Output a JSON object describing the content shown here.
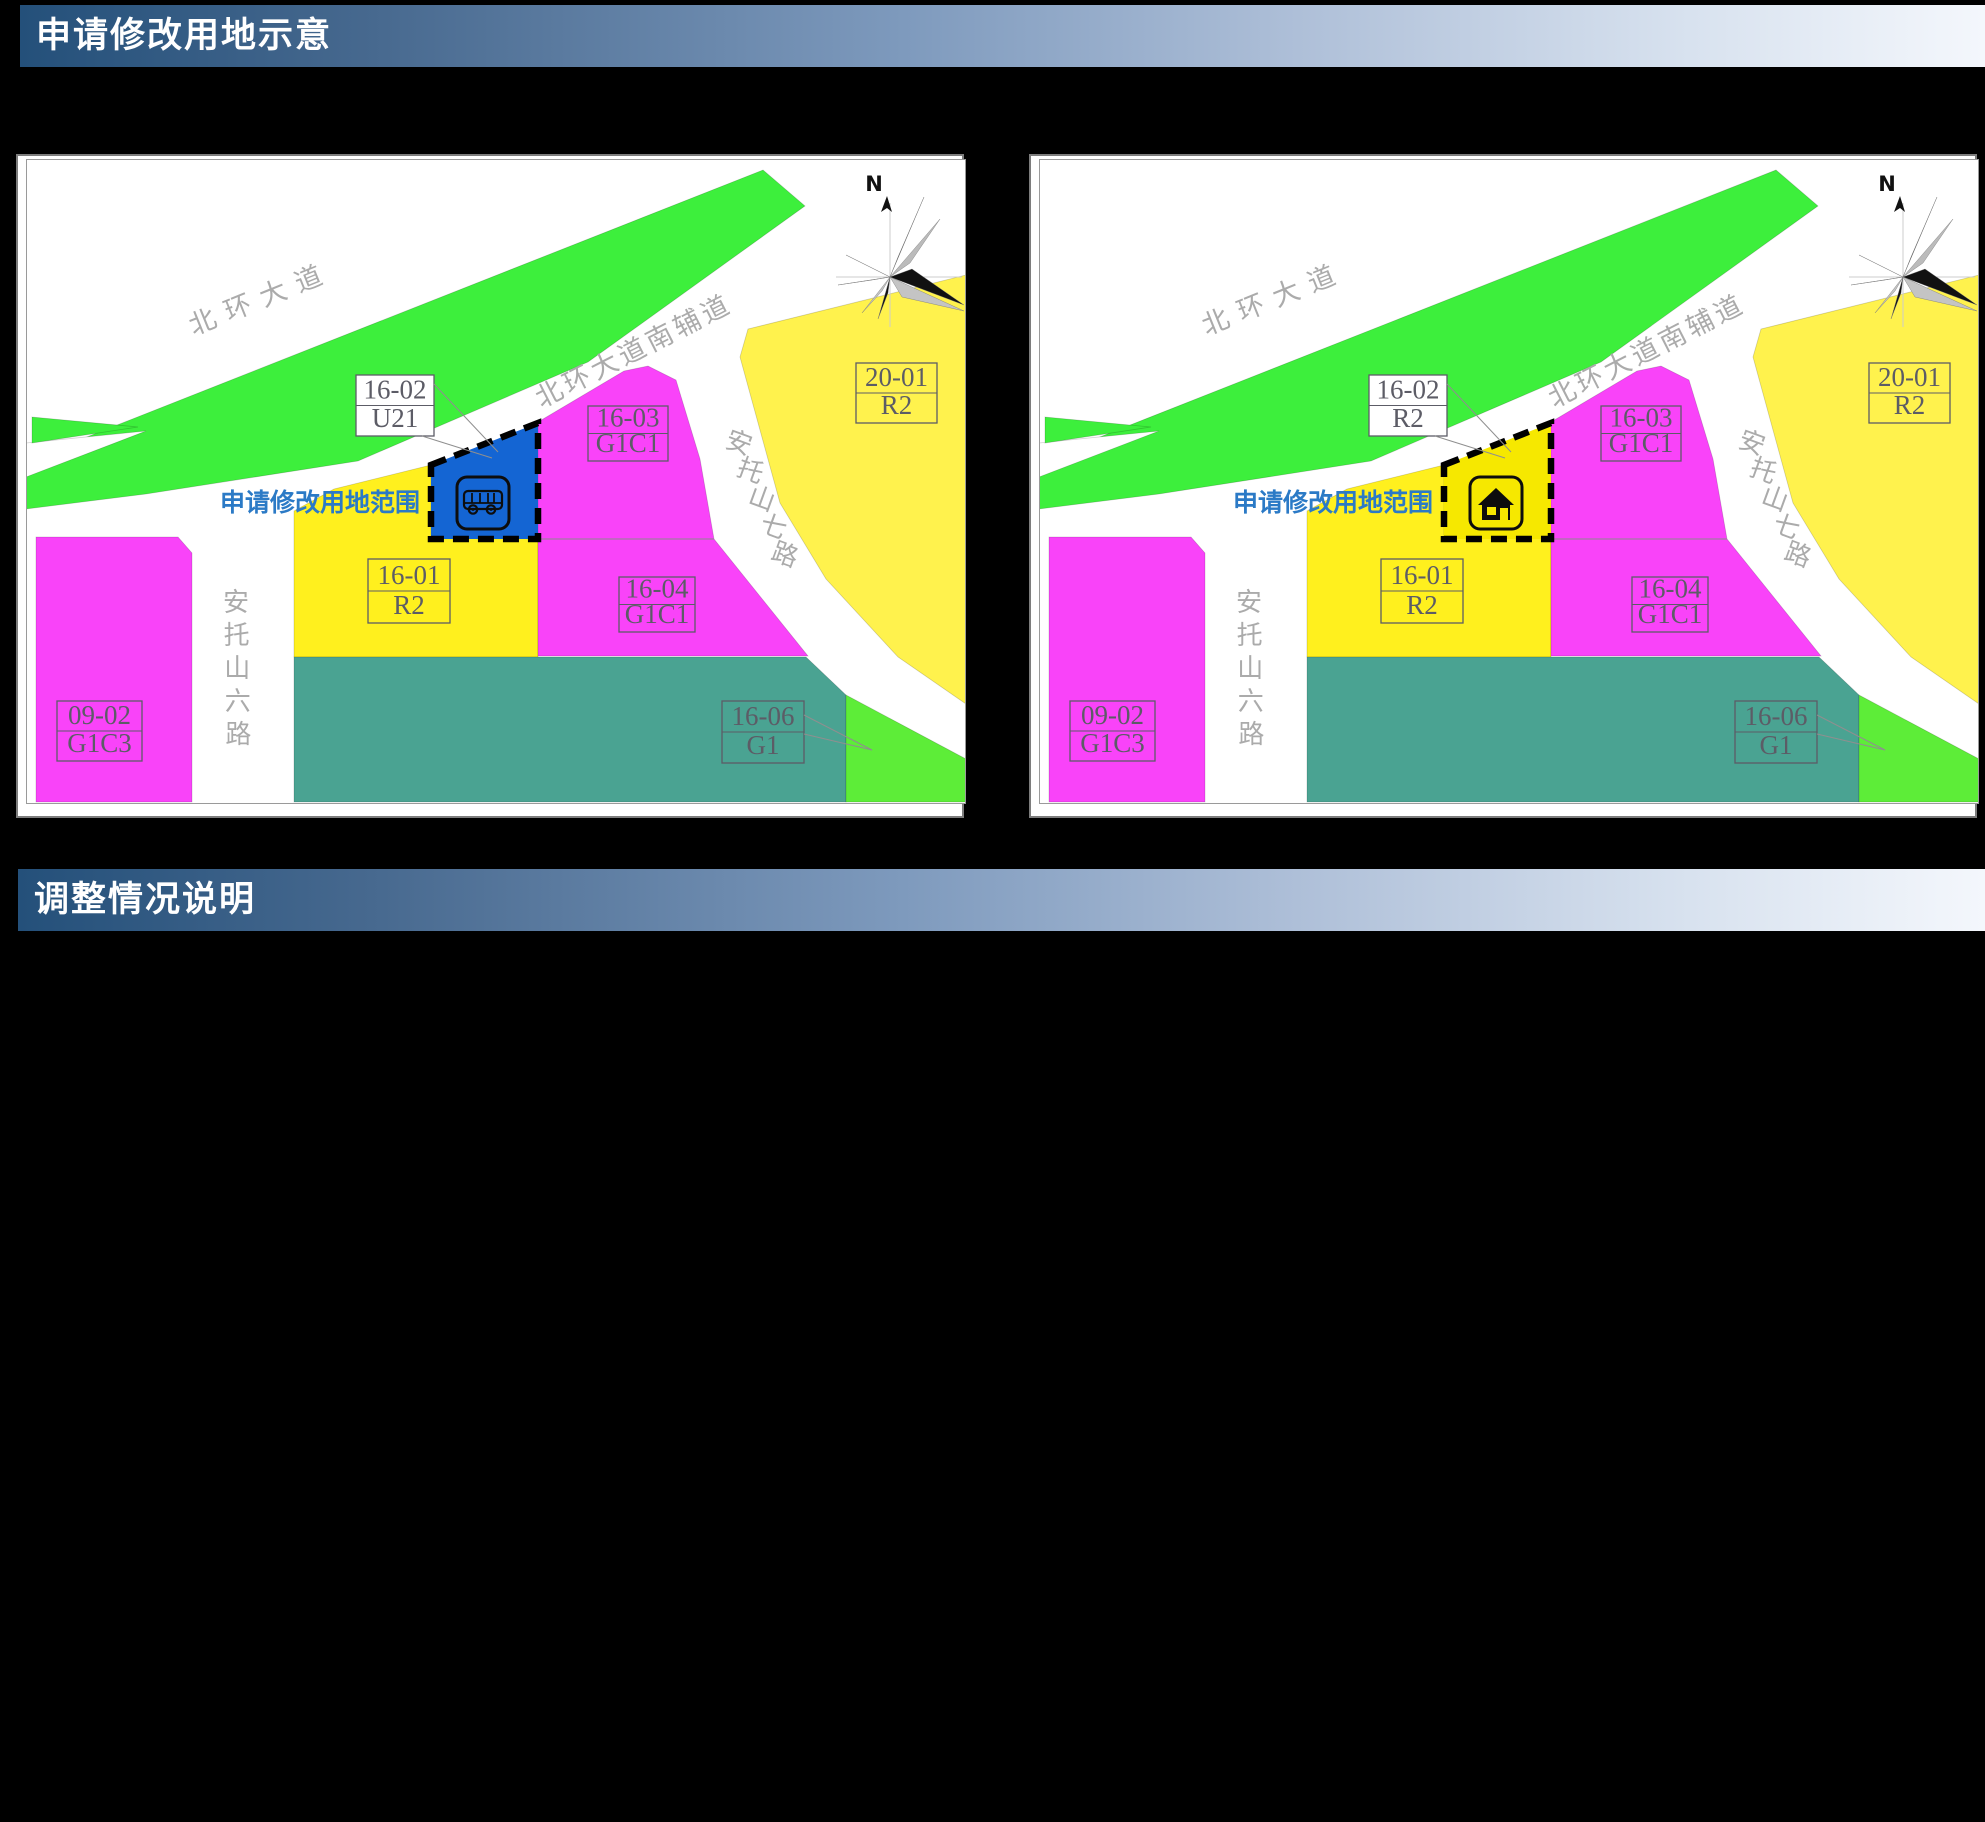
{
  "headers": {
    "section1": "申请修改用地示意",
    "section2": "调整情况说明"
  },
  "annotation": {
    "label": "申请修改用地范围"
  },
  "compass": {
    "north_label": "N"
  },
  "roads": {
    "beihuan": "北环大道",
    "beihuan_aux": "北环大道南辅道",
    "antuoshan6": "安托山六路",
    "antuoshan7": "安托山七路"
  },
  "parcels": {
    "p0902": {
      "code": "09-02",
      "use": "G1C3"
    },
    "p1601": {
      "code": "16-01",
      "use": "R2"
    },
    "p1603": {
      "code": "16-03",
      "use": "G1C1"
    },
    "p1604": {
      "code": "16-04",
      "use": "G1C1"
    },
    "p1606": {
      "code": "16-06",
      "use": "G1"
    },
    "p2001": {
      "code": "20-01",
      "use": "R2"
    }
  },
  "maps": {
    "left": {
      "modified_parcel": {
        "code": "16-02",
        "use": "U21",
        "fill": "#1465d3",
        "icon": "bus"
      }
    },
    "right": {
      "modified_parcel": {
        "code": "16-02",
        "use": "R2",
        "fill": "#f6e800",
        "icon": "house"
      }
    }
  },
  "colors": {
    "green_belt": "#3def3c",
    "green_parcel": "#5ded38",
    "magenta": "#f943f9",
    "yellow": "#fff01e",
    "yellow_light": "#fff24d",
    "teal": "#4aa392",
    "road_text": "#ababab",
    "box_line": "#5c5c66",
    "annotation_text": "#2b7ac6",
    "icon_ink": "#0d0d0d"
  }
}
